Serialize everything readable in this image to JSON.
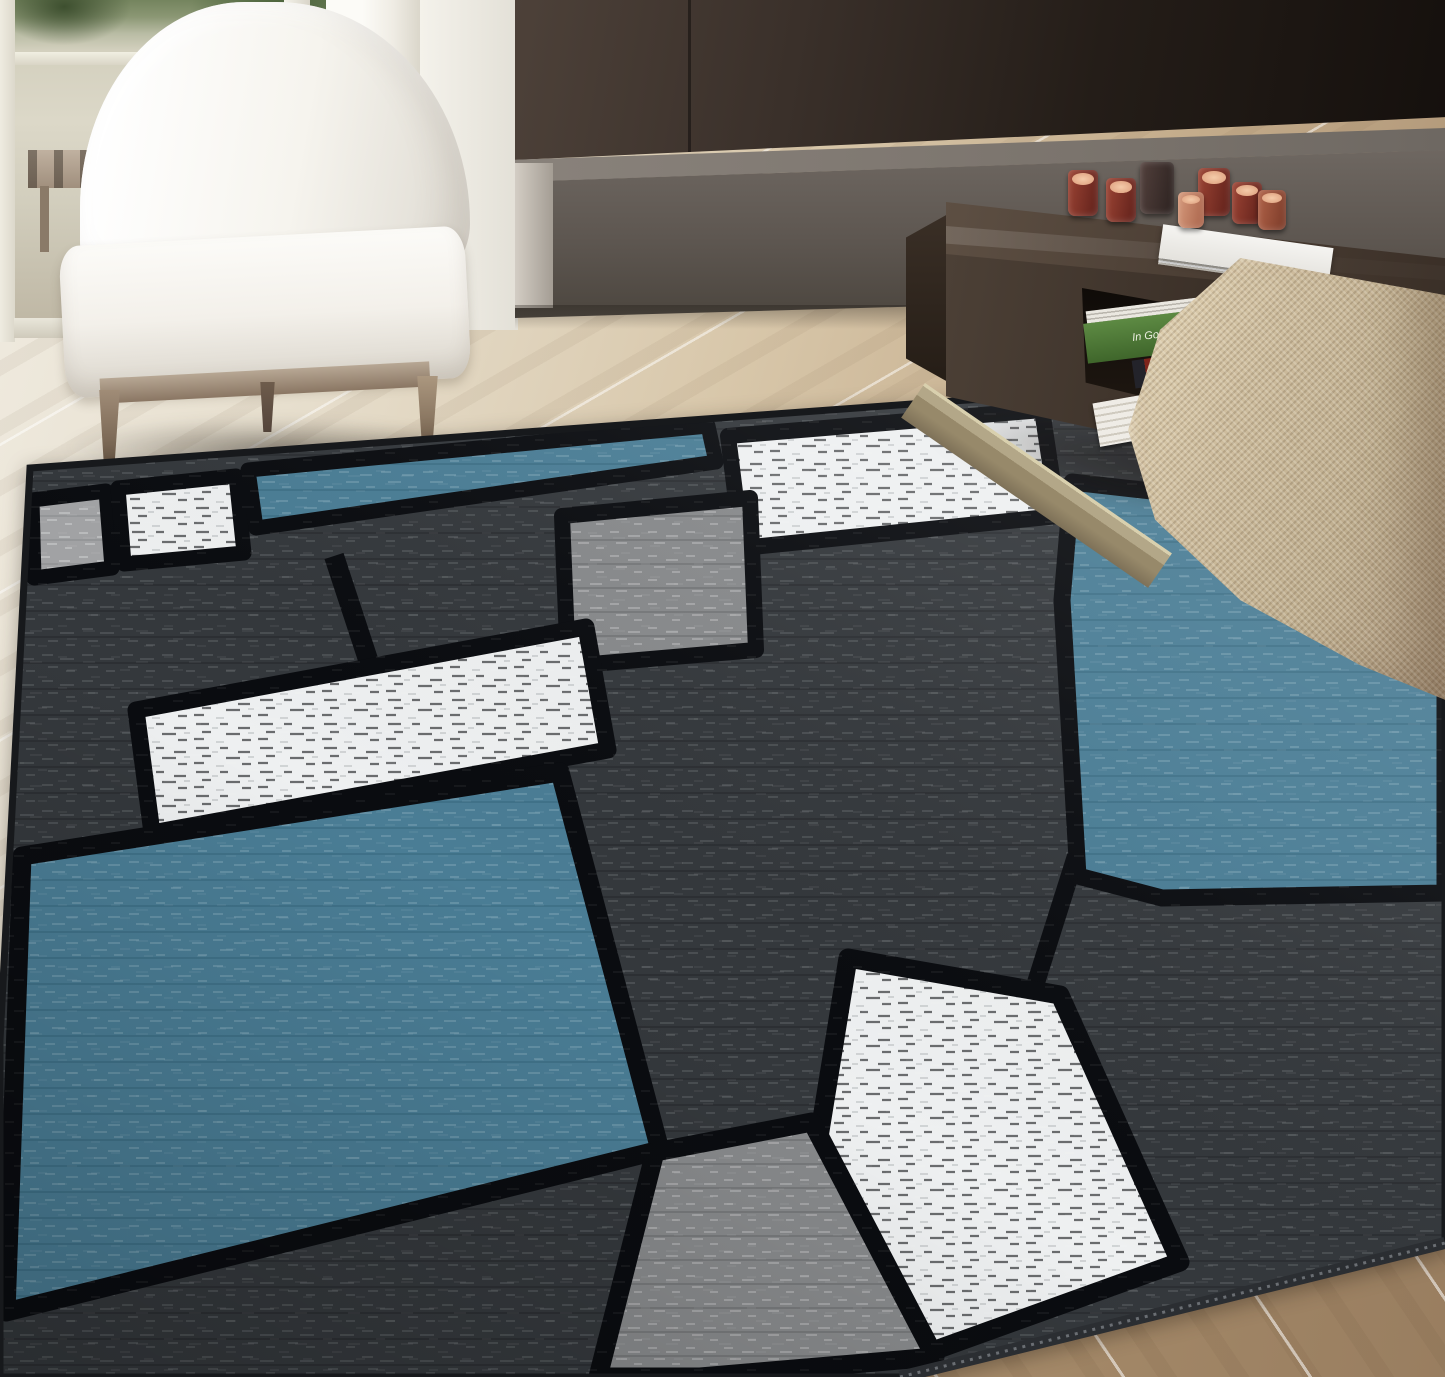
{
  "scene": {
    "type": "product lifestyle photograph",
    "description": "Modern living room with a blue, gray, white and black color-block area rug on light wood plank flooring; a white upholstered slipper chair stands by a glass door on the left, a dark brown feature wall with a low gray bench runs across the back, a dark wood coffee table with red glass tealight candles and books sits at the right, and a beige woven barrel chair enters the right foreground.",
    "lighting": "bright daylight entering from the glass door on the left"
  },
  "room": {
    "floor": {
      "material": "light oak planks laid diagonally",
      "tone_far": "#f1ede3",
      "tone_near": "#9a7f61",
      "plank_gap_color": "#ffffff"
    },
    "back_wall": {
      "left": "glass door to terrace with greenery and a wooden slat bench outside",
      "middle": "white wall",
      "right": "dark brown feature wall",
      "white_wall_color": "#f4f2eb",
      "dark_wall_color": "#2a211b"
    },
    "bench": {
      "label": "low gray stone bench / hearth ledge",
      "top_color": "#7d766f",
      "front_color": "#5d5650"
    },
    "outside_view": {
      "foliage_color": "#5e724a",
      "deck_bench": "wood slat bench",
      "backdrop_color": "#d6d2c2"
    }
  },
  "furniture": {
    "armchair": {
      "label": "white upholstered armless slipper chair",
      "fabric_color": "#f6f4ef",
      "base_wood_color": "#9c8874",
      "visible_legs": 3
    },
    "coffee_table": {
      "label": "dark walnut coffee table with open magazine shelf",
      "top_color": "#4a3d33",
      "base_rail_color": "#a79b7d",
      "candles": {
        "count": 7,
        "glass_colors": [
          "#9c4434",
          "#5f201a",
          "#2c2220",
          "#b06248",
          "#d69a7c"
        ],
        "wax_color": "#e9b892"
      },
      "books": [
        {
          "spine_text": "In Godsnaam",
          "cover_color": "#56813f",
          "text_color": "#eef0e2"
        },
        {
          "spine_text": "NEW YORK",
          "cover_color": "#23232a",
          "accent_color": "#7e241b",
          "text_color": "#e8e6e2"
        },
        {
          "label": "white coffee-table book on tabletop",
          "color": "#f2f1ee"
        },
        {
          "label": "stacked magazines in shelf",
          "colors": [
            "#efece6",
            "#c96a33",
            "#2f2f33"
          ]
        }
      ]
    },
    "accent_chair": {
      "label": "beige woven barrel chair, right foreground",
      "fabric_color": "#c7b698",
      "highlight_color": "#ecdfc2"
    }
  },
  "rug": {
    "label": "contemporary color-block area rug",
    "style": "Mondrian-style boxes with thick black outlines and heathered texture",
    "edge_binding_color": "#2b2e32",
    "palette": {
      "blue": "#4a7d95",
      "dark_gray": "#34383c",
      "medium_gray": "#87898b",
      "light_gray": "#a2a3a5",
      "white": "#eef0f1",
      "black_lines": "#0a0c10"
    },
    "blocks": [
      {
        "id": "top-band",
        "color": "dark_gray"
      },
      {
        "id": "row1-left-square",
        "color": "light_gray"
      },
      {
        "id": "row1-white-square",
        "color": "white"
      },
      {
        "id": "row1-blue-rectangle",
        "color": "blue"
      },
      {
        "id": "row1-big-white-square",
        "color": "white"
      },
      {
        "id": "center-gray-square",
        "color": "medium_gray"
      },
      {
        "id": "left-tall-block",
        "color": "dark_gray"
      },
      {
        "id": "middle-white-rectangle",
        "color": "white"
      },
      {
        "id": "right-blue-block",
        "color": "blue"
      },
      {
        "id": "bottom-left-blue-block",
        "color": "blue"
      },
      {
        "id": "center-dark-block",
        "color": "dark_gray"
      },
      {
        "id": "bottom-white-square",
        "color": "white"
      },
      {
        "id": "bottom-gray-square",
        "color": "medium_gray"
      }
    ]
  }
}
